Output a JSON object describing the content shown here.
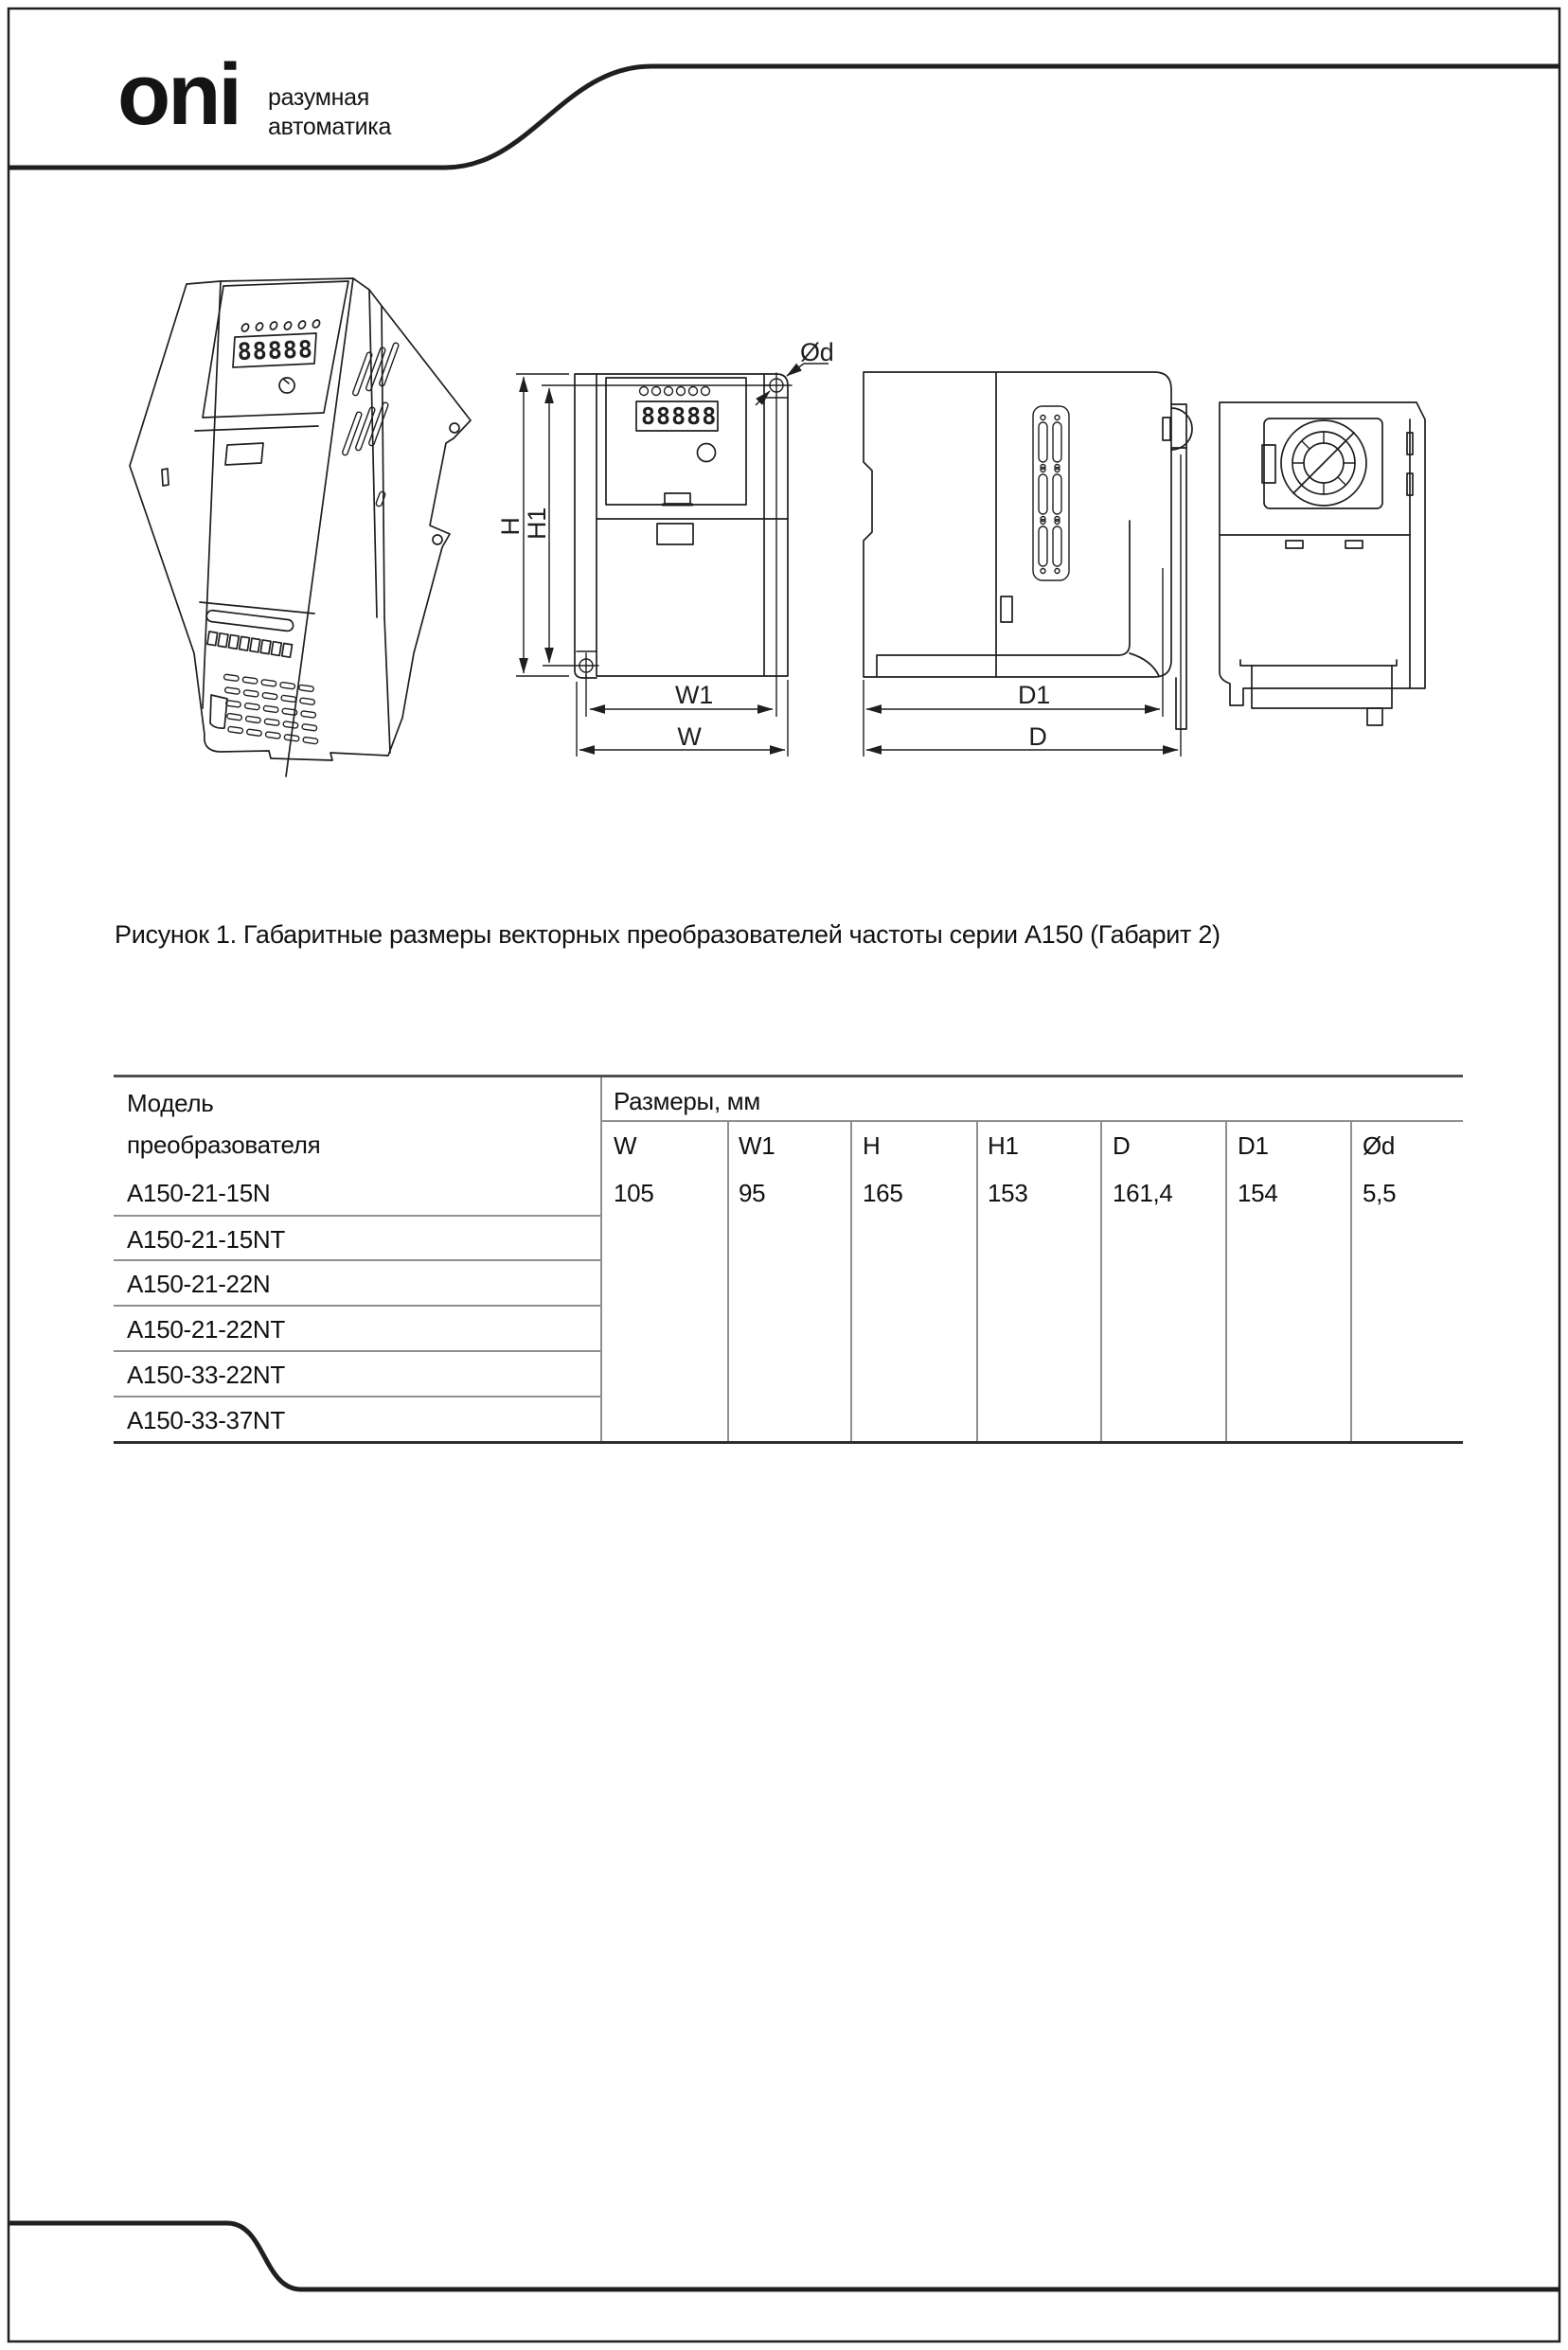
{
  "header": {
    "logo": "oni",
    "tagline_line1": "разумная",
    "tagline_line2": "автоматика"
  },
  "figure": {
    "caption": "Рисунок 1. Габаритные размеры векторных преобразователей частоты серии А150 (Габарит 2)",
    "display_value": "88888",
    "dim_labels": {
      "h": "H",
      "h1": "H1",
      "w": "W",
      "w1": "W1",
      "d": "D",
      "d1": "D1",
      "dia": "Ød"
    }
  },
  "table": {
    "col1_header_line1": "Модель",
    "col1_header_line2": "преобразователя",
    "group_header": "Размеры, мм",
    "columns": [
      "W",
      "W1",
      "H",
      "H1",
      "D",
      "D1",
      "Ød"
    ],
    "models": [
      "A150-21-15N",
      "A150-21-15NT",
      "A150-21-22N",
      "A150-21-22NT",
      "A150-33-22NT",
      "A150-33-37NT"
    ],
    "values": [
      "105",
      "95",
      "165",
      "153",
      "161,4",
      "154",
      "5,5"
    ]
  },
  "colors": {
    "line": "#1f1f1f",
    "table_border_top": "#4f4f4f",
    "table_border_bottom": "#2f2f2f",
    "table_grid": "#8f8f8f"
  }
}
